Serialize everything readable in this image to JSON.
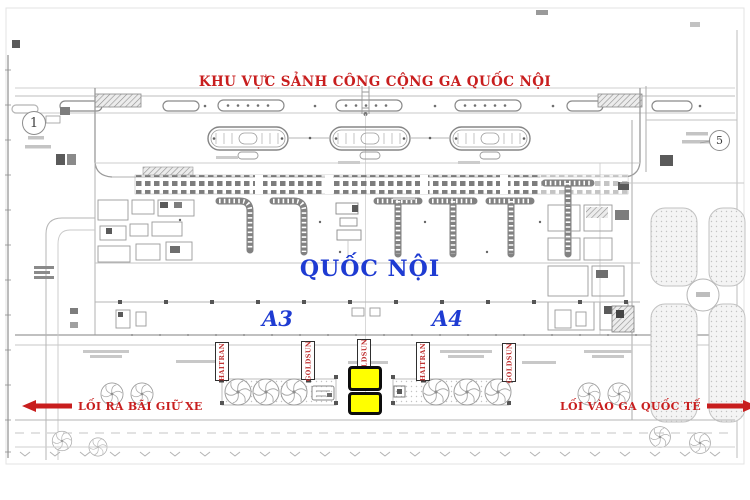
{
  "header": {
    "title": "KHU VỰC SẢNH CÔNG CỘNG GA QUỐC NỘI"
  },
  "zones": {
    "hall_label": "QUỐC NỘI",
    "area_left": "A3",
    "area_right": "A4"
  },
  "badges": {
    "left_circle": "1",
    "right_circle": "5"
  },
  "ad_panels": [
    {
      "label": "HAITRAN"
    },
    {
      "label": "GOLDSUN"
    },
    {
      "label": "GOLDSUN"
    },
    {
      "label": "HAITRAN"
    },
    {
      "label": "GOLDSUN"
    }
  ],
  "highlights": {
    "count": 2,
    "color": "#ffff00"
  },
  "footer": {
    "exit_parking": "LỐI RA BÃI GIỮ XE",
    "entrance_international": "LỐI VÀO GA QUỐC TẾ"
  },
  "colors": {
    "accent_red": "#c81e1e",
    "accent_blue": "#1e3bd2",
    "highlight_yellow": "#ffff00"
  }
}
